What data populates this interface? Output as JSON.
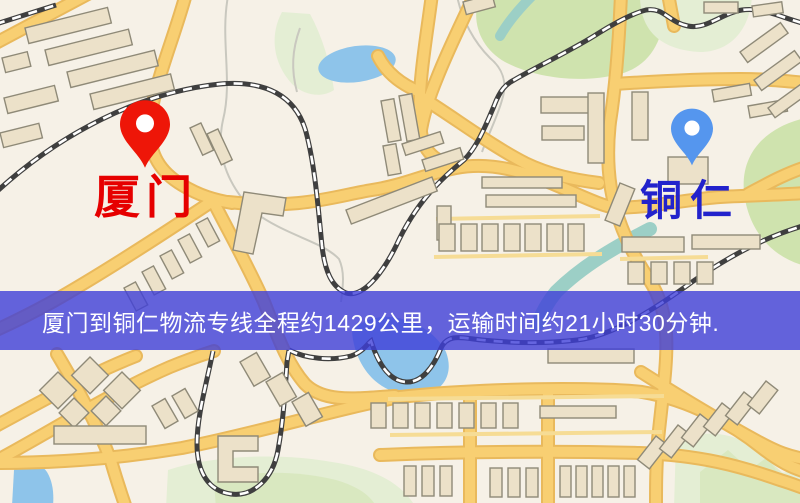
{
  "banner": {
    "text": "厦门到铜仁物流专线全程约1429公里，运输时间约21小时30分钟.",
    "background_color": "rgba(62,62,216,0.8)",
    "text_color": "#ffffff"
  },
  "markers": {
    "origin": {
      "label": "厦门",
      "icon": "location-pin-icon",
      "pin_color": "#ee1608",
      "label_color": "#e60000"
    },
    "destination": {
      "label": "铜仁",
      "icon": "location-pin-icon",
      "pin_color": "#5596ee",
      "label_color": "#2222cc"
    }
  },
  "map": {
    "type": "street-map",
    "palette": {
      "background": "#f6f1e7",
      "road_major": "#f8cf72",
      "road_casing": "#e9b95c",
      "road_minor": "#f6dc95",
      "park": "#cfe3ae",
      "park_light": "#e4eed4",
      "water": "#8ec4ea",
      "river_teal": "#9ccfc6",
      "railway": "#3f3f3f",
      "building": "#ece1c9",
      "building_outline": "#8f8a78",
      "stream": "#c9c8bf"
    }
  }
}
